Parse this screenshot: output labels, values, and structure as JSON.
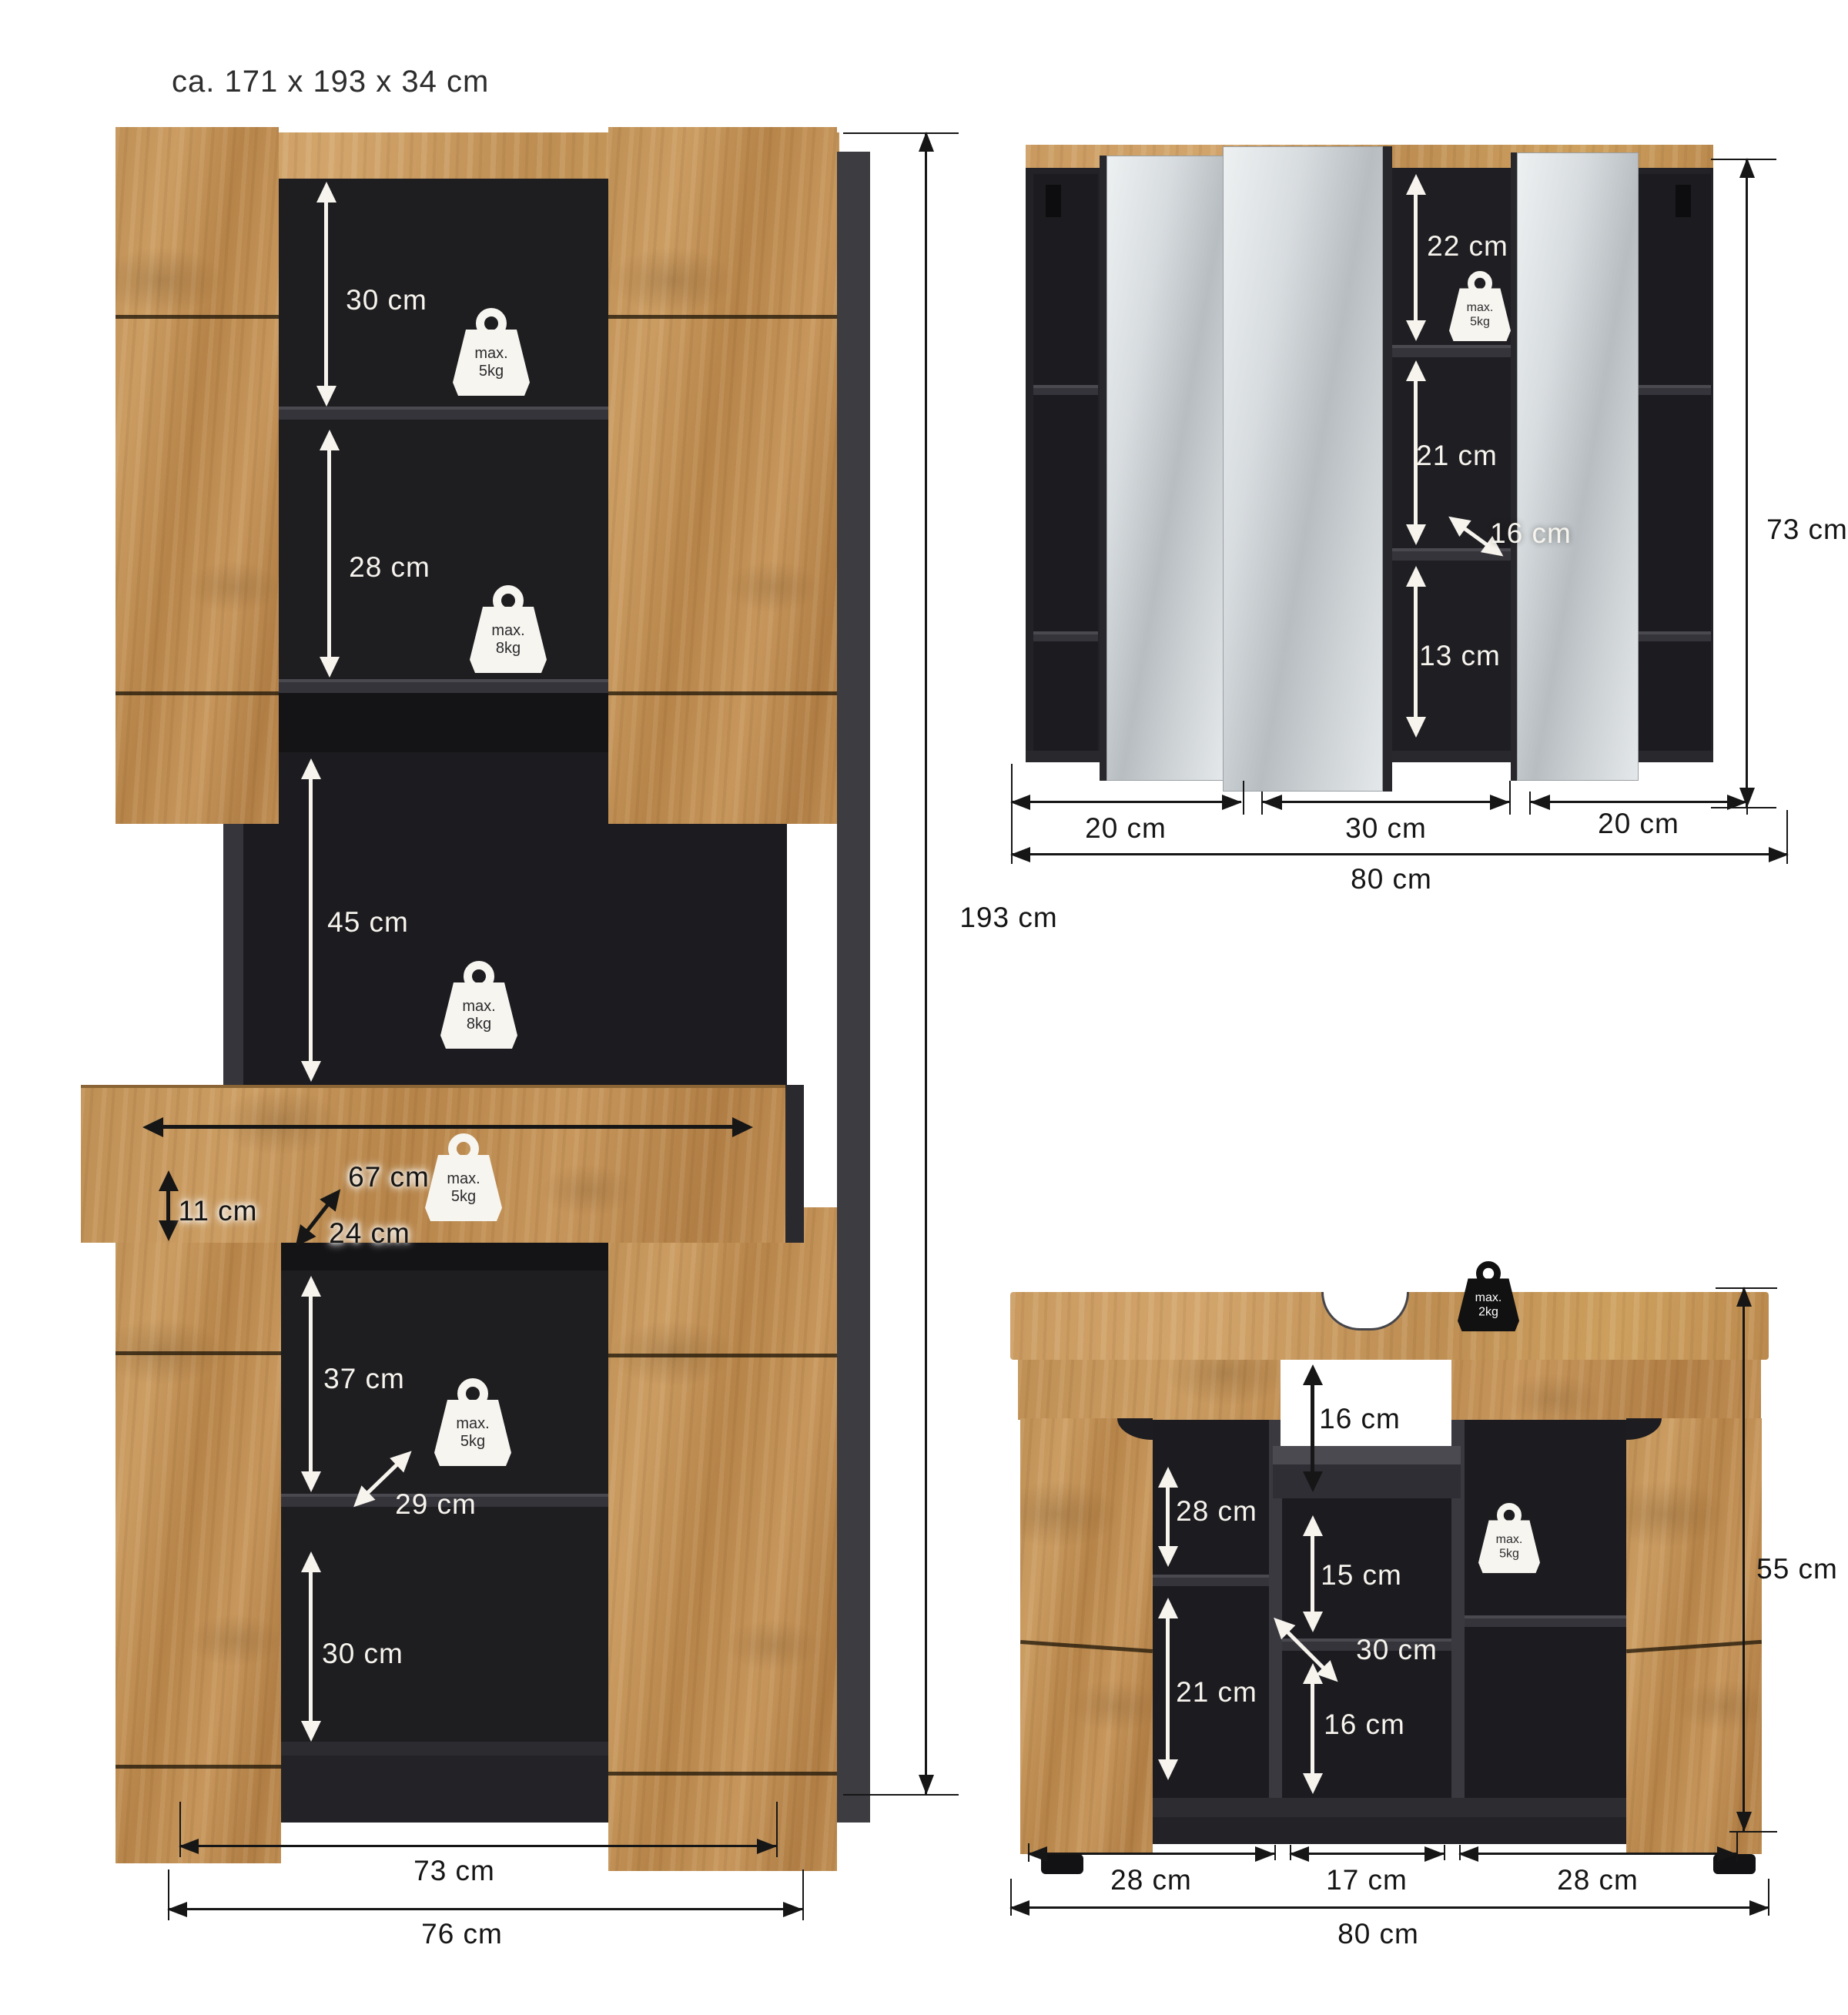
{
  "title": "ca. 171 x 193 x 34 cm",
  "tall_cabinet": {
    "dims": {
      "top_shelf": "30 cm",
      "second_shelf": "28 cm",
      "open_compartment": "45 cm",
      "drawer_width": "67 cm",
      "drawer_height": "11 cm",
      "drawer_depth": "24 cm",
      "lower_compartment": "37 cm",
      "lower_depth": "29 cm",
      "bottom_shelf": "30 cm",
      "total_height": "193 cm",
      "inner_width": "73 cm",
      "total_width": "76 cm"
    },
    "max_loads": [
      {
        "label": "max.",
        "value": "5kg"
      },
      {
        "label": "max.",
        "value": "8kg"
      },
      {
        "label": "max.",
        "value": "8kg"
      },
      {
        "label": "max.",
        "value": "5kg"
      },
      {
        "label": "max.",
        "value": "5kg"
      }
    ]
  },
  "mirror_cabinet": {
    "dims": {
      "top_section": "22 cm",
      "middle_section": "21 cm",
      "shelf_depth": "16 cm",
      "bottom_section": "13 cm",
      "total_height": "73 cm",
      "left_door_width": "20 cm",
      "center_door_width": "30 cm",
      "right_door_width": "20 cm",
      "total_width": "80 cm"
    },
    "max_loads": [
      {
        "label": "max.",
        "value": "5kg"
      }
    ]
  },
  "vanity_cabinet": {
    "dims": {
      "siphon_clearance": "16 cm",
      "upper_left_compartment": "28 cm",
      "center_shelf": "15 cm",
      "shelf_depth": "30 cm",
      "lower_left_compartment": "21 cm",
      "lower_center_compartment": "16 cm",
      "total_height": "55 cm",
      "left_door_width": "28 cm",
      "center_width": "17 cm",
      "right_door_width": "28 cm",
      "total_width": "80 cm"
    },
    "max_loads": [
      {
        "label": "max.",
        "value": "2kg"
      },
      {
        "label": "max.",
        "value": "5kg"
      }
    ]
  }
}
